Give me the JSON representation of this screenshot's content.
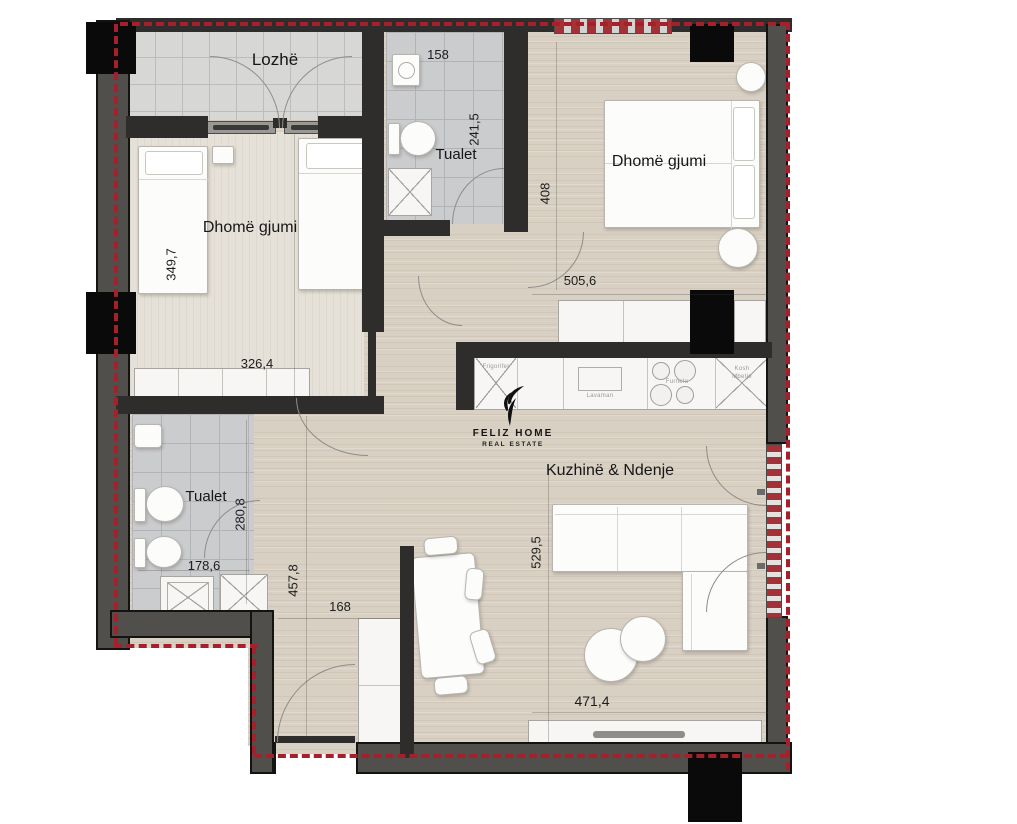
{
  "floorplan": {
    "brand": {
      "name": "FELIZ HOME",
      "tagline": "REAL ESTATE"
    },
    "rooms": {
      "loggia": {
        "label": "Lozhë"
      },
      "toilet_top": {
        "label": "Tualet",
        "width": "158",
        "height": "241,5"
      },
      "bedroom_right": {
        "label": "Dhomë gjumi",
        "height": "408",
        "width": "505,6"
      },
      "bedroom_left": {
        "label": "Dhomë gjumi",
        "height": "349,7",
        "width": "326,4"
      },
      "toilet_bottom": {
        "label": "Tualet",
        "height": "280,8",
        "width": "178,6"
      },
      "hallway": {
        "height": "457,8",
        "width": "168"
      },
      "living": {
        "label": "Kuzhinë & Ndenje",
        "height": "529,5",
        "width": "471,4"
      }
    },
    "kitchen": {
      "fridge": "Frigorifer",
      "sink": "Lavaman",
      "stove": "Furnela",
      "cabinet_line1": "Kosh",
      "cabinet_line2": "Mbetje"
    },
    "colors": {
      "wall": "#2e2d2b",
      "outer_wall": "#514f4c",
      "boundary_red": "#a6202b",
      "column": "#0a0a0a",
      "floor_wood": "#d8d0c3",
      "floor_tile": "#d7d7d6"
    }
  }
}
